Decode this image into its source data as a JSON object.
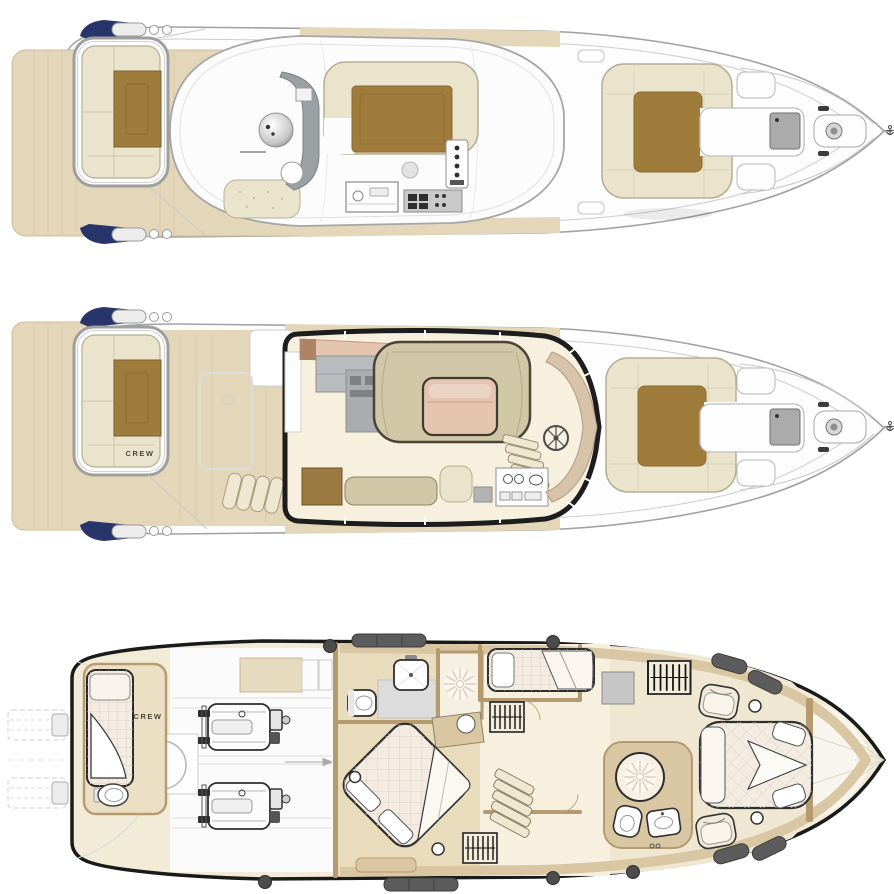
{
  "labels": {
    "main_deck_crew": "CREW",
    "lower_deck_crew": "CREW"
  },
  "palette": {
    "teak_decking": "#e4d7b9",
    "cushion_cream": "#e9e4cb",
    "pad_brown": "#a07c3c",
    "navy_accent": "#28356b",
    "floor_cream": "#f7f0de",
    "room_beige": "#ece0c4",
    "wall_tan": "#b5996f",
    "furniture_tan": "#d9c7a4",
    "sofa_khaki": "#cfc7a6",
    "salmon_table": "#e4c5af",
    "appliance_gray": "#b9bcbe",
    "mattress_white": "#f4ece2",
    "fender_gray": "#5c5c5c",
    "hull_line": "#a2a2a2",
    "outline_dark": "#1a1a1a"
  }
}
